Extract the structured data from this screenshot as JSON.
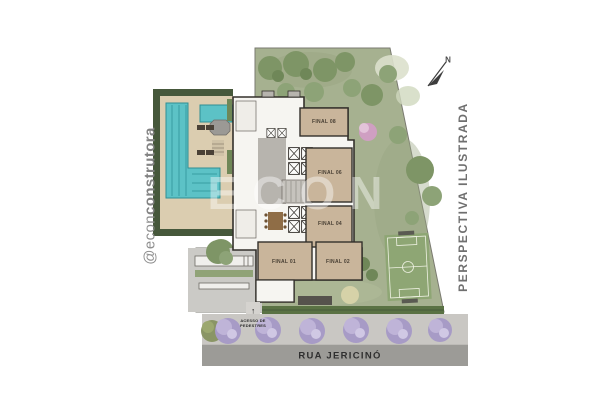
{
  "branding": {
    "handle_prefix": "@econ",
    "handle_suffix": "construtora"
  },
  "annotations": {
    "perspective_label": "PERSPECTIVA ILUSTRADA",
    "north_label": "N",
    "street_name": "RUA JERICINÓ",
    "pedestrian_access_line1": "ACESSO DE",
    "pedestrian_access_line2": "PEDESTRES",
    "pedestrian_arrow": "↑",
    "watermark": "ECON"
  },
  "units": [
    {
      "label": "FINAL 08"
    },
    {
      "label": "FINAL 06"
    },
    {
      "label": "FINAL 04"
    },
    {
      "label": "FINAL 01"
    },
    {
      "label": "FINAL 02"
    }
  ],
  "palette": {
    "garden_green": "#a6b190",
    "hedge_dark_green": "#46583b",
    "pool_water": "#5cc2c6",
    "deck_beige": "#dbcdb0",
    "unit_fill_tan": "#c9b59b",
    "building_outline": "#33302b",
    "street_gray": "#9c9b97",
    "sidewalk_gray": "#c9c7c3",
    "flowering_tree_purple": "#a79bc6",
    "soccer_field_green": "#8ea674"
  }
}
